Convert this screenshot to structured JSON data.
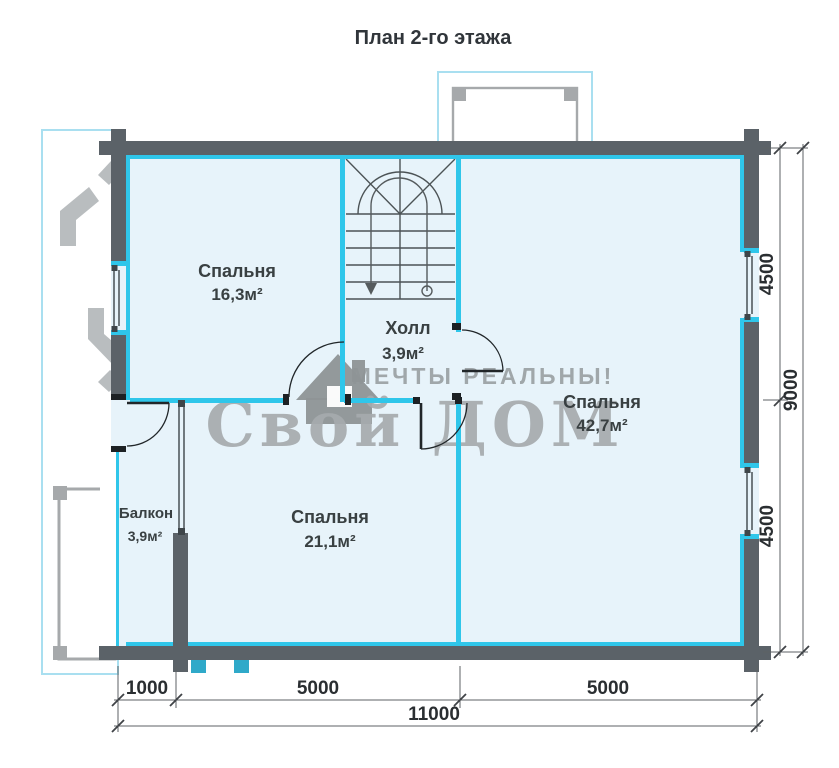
{
  "title": "План 2-го этажа",
  "watermark": {
    "tagline": "МЕЧТЫ РЕАЛЬНЫ!",
    "brand": "Свой ДОМ"
  },
  "rooms": {
    "bedroom1": {
      "name": "Спальня",
      "area": "16,3м²"
    },
    "hall": {
      "name": "Холл",
      "area": "3,9м²"
    },
    "bedroom2": {
      "name": "Спальня",
      "area": "42,7м²"
    },
    "bedroom3": {
      "name": "Спальня",
      "area": "21,1м²"
    },
    "balcony": {
      "name": "Балкон",
      "area": "3,9м²"
    }
  },
  "dimensions": {
    "right_top": "4500",
    "right_total": "9000",
    "right_bottom": "4500",
    "bottom_1": "1000",
    "bottom_2": "5000",
    "bottom_3": "5000",
    "bottom_total": "11000"
  },
  "colors": {
    "wall": "#5b6268",
    "partition": "#2fc6ea",
    "room_fill": "#e7f3fa",
    "watermark": "#a6abae",
    "annex_border": "#a9dff0"
  }
}
